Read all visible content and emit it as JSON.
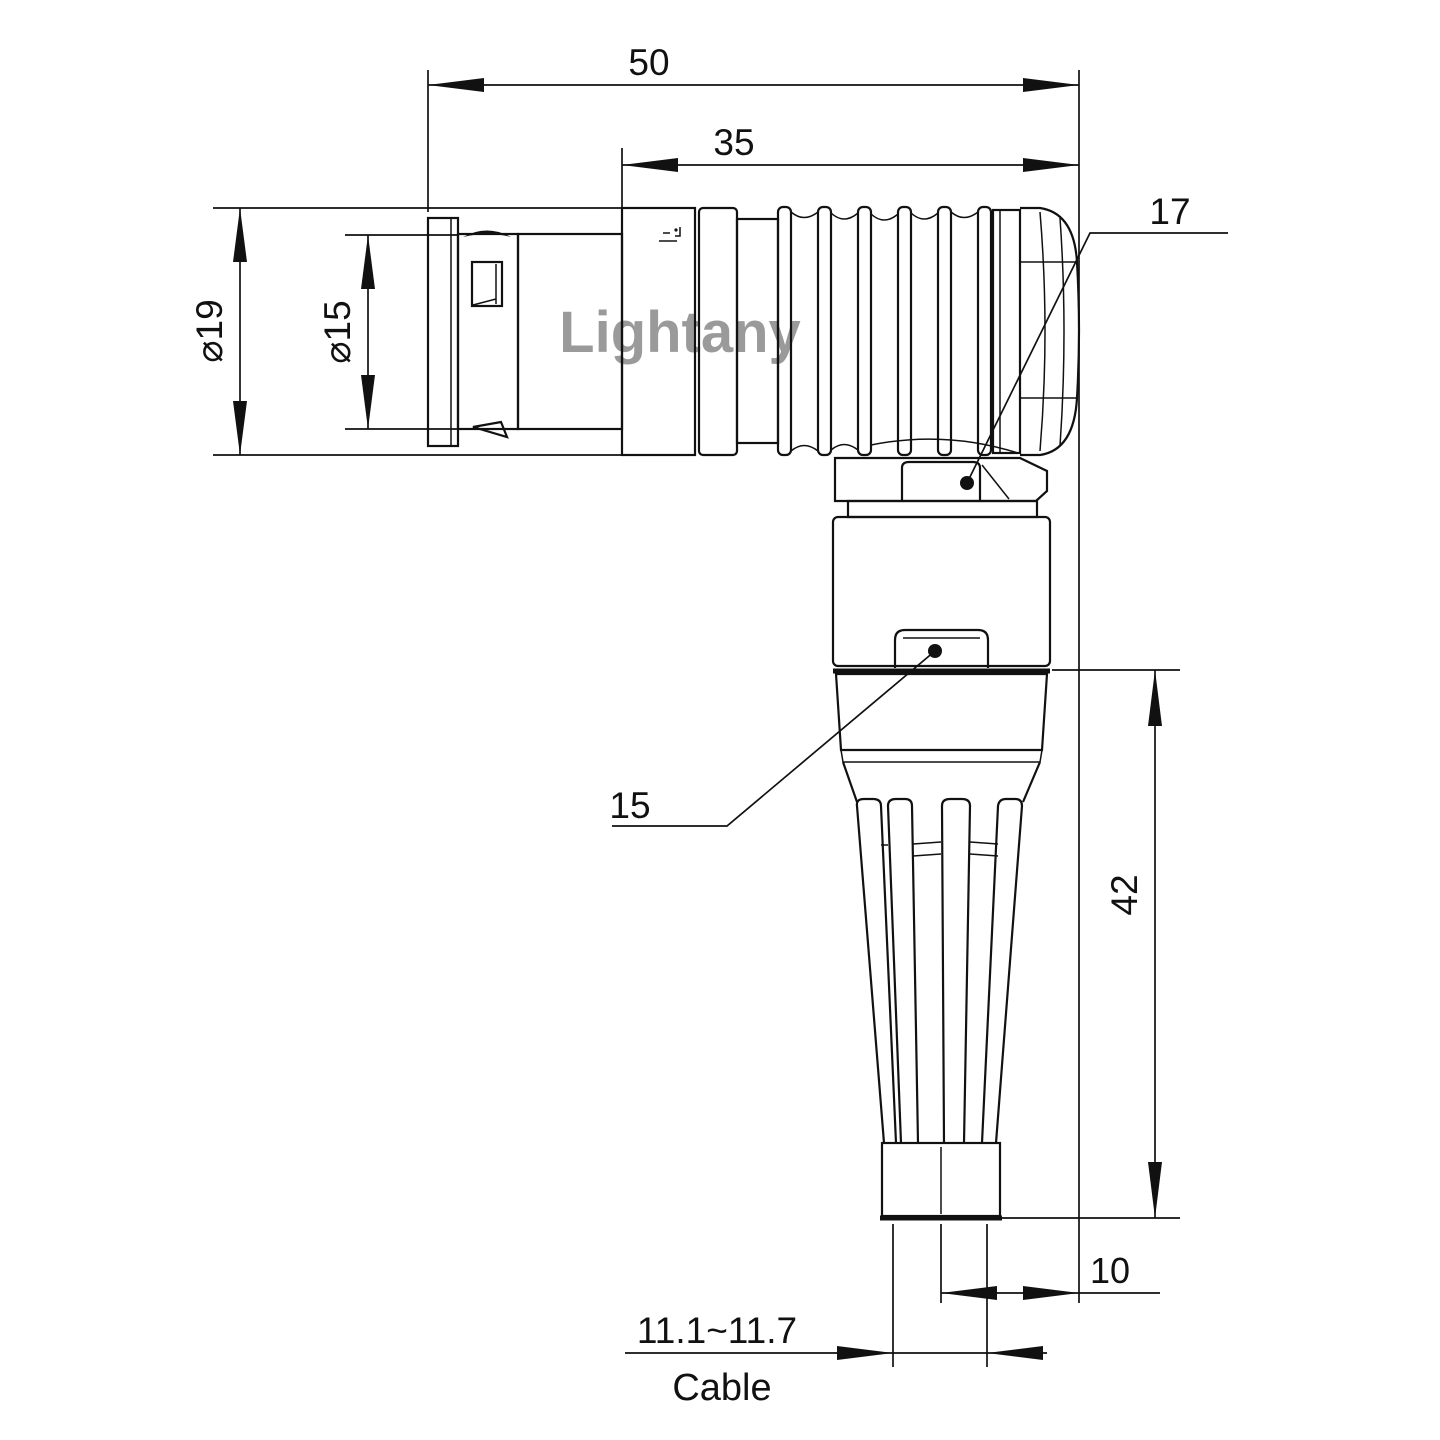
{
  "watermark": {
    "text": "Lightany",
    "color": "#f0b9b9"
  },
  "dims": {
    "d50": "50",
    "d35": "35",
    "dia19": "⌀19",
    "dia15": "⌀15",
    "r17": "17",
    "r15": "15",
    "d42": "42",
    "d10": "10",
    "cable_range": "11.1~11.7",
    "cable": "Cable"
  },
  "colors": {
    "line": "#111111",
    "background": "#ffffff",
    "watermark": "#f0b9b9"
  }
}
